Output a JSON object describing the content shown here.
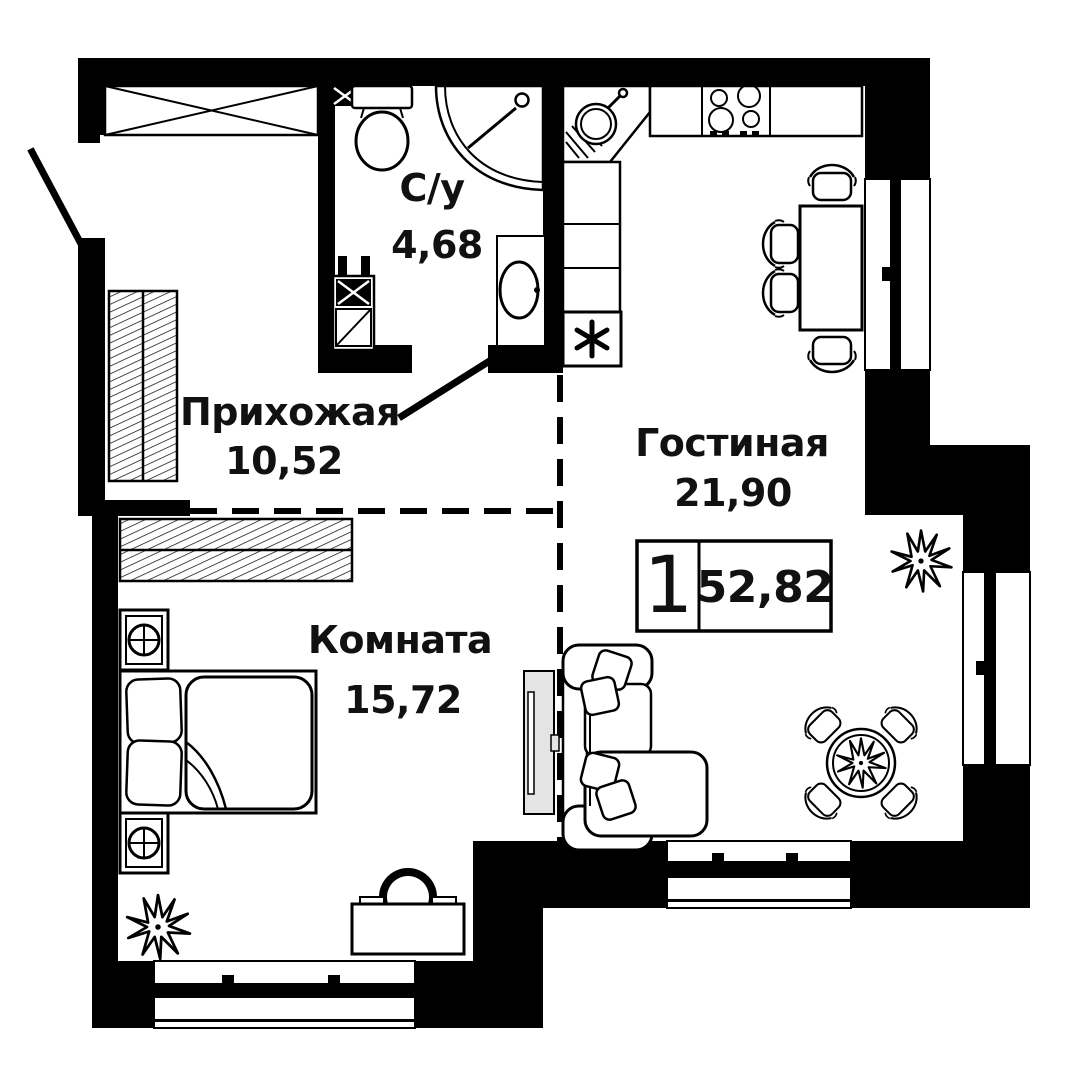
{
  "badge": {
    "rooms_count": "1",
    "total_area": "52,82"
  },
  "rooms": [
    {
      "id": "hallway",
      "name": "Прихожая",
      "area": "10,52"
    },
    {
      "id": "bathroom",
      "name": "С/у",
      "area": "4,68"
    },
    {
      "id": "living",
      "name": "Гостиная",
      "area": "21,90"
    },
    {
      "id": "bedroom",
      "name": "Комната",
      "area": "15,72"
    }
  ],
  "colors": {
    "walls": "#000000",
    "background": "#ffffff",
    "tv_panel": "#e4e4e4"
  },
  "icons": {
    "furniture": [
      "entrance-door",
      "bathroom-door",
      "toilet",
      "shower",
      "bath-sink",
      "utility-riser",
      "kitchen-corner-sink",
      "kitchen-counter",
      "stove",
      "fridge",
      "dining-table",
      "chair",
      "sofa",
      "tv-panel",
      "round-table",
      "bed",
      "nightstand-lamp",
      "wardrobe",
      "closet",
      "desk",
      "desk-chair",
      "plant",
      "window"
    ]
  }
}
